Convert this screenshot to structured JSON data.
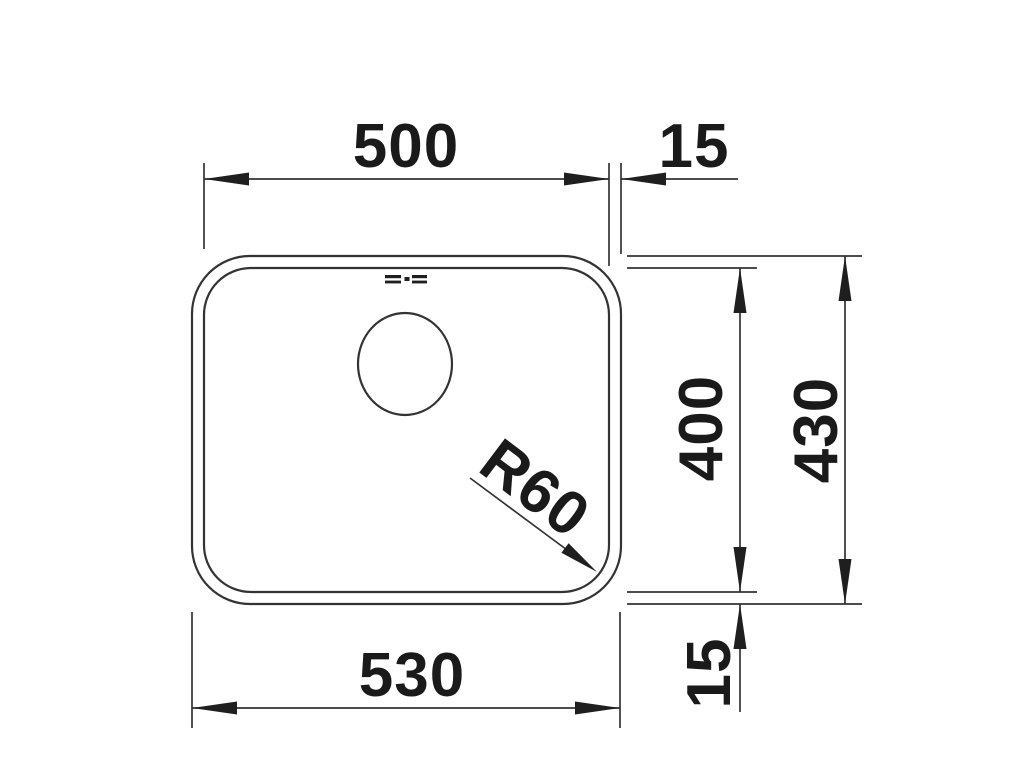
{
  "drawing": {
    "labels": {
      "inner_width": "500",
      "rim_offset_right": "15",
      "inner_depth": "400",
      "outer_depth": "430",
      "rim_offset_bottom": "15",
      "outer_width": "530",
      "corner_radius": "R60"
    },
    "colors": {
      "line": "#333333",
      "text": "#1a1a1a",
      "background": "#ffffff"
    }
  }
}
